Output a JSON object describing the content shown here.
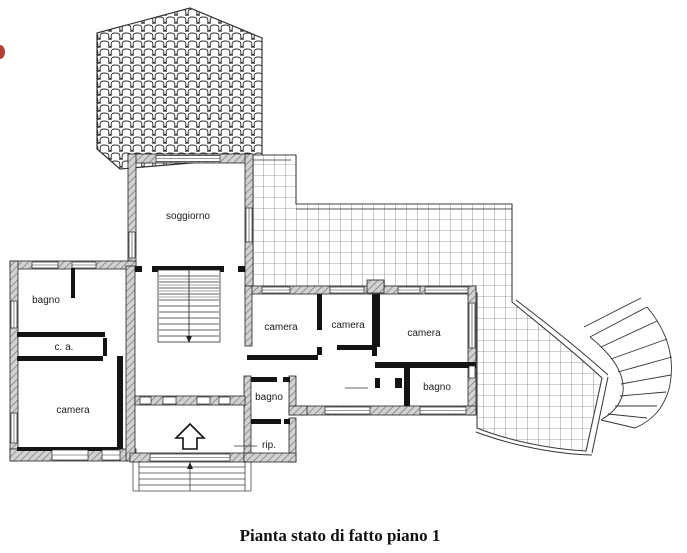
{
  "title": "Pianta stato di fatto piano 1",
  "colors": {
    "ink": "#1c1c1c",
    "wall_hatch_fill": "#d2d2d2",
    "grid_line": "#4d4d4d",
    "accent_mark": "#b4403a"
  },
  "rooms": [
    {
      "id": "soggiorno",
      "label": "soggiorno",
      "x": 188,
      "y": 219
    },
    {
      "id": "bagno-nordovest",
      "label": "bagno",
      "x": 46,
      "y": 303
    },
    {
      "id": "cabina-armadio",
      "label": "c. a.",
      "x": 64,
      "y": 350
    },
    {
      "id": "camera-ovest",
      "label": "camera",
      "x": 73,
      "y": 413
    },
    {
      "id": "camera-centro-1",
      "label": "camera",
      "x": 281,
      "y": 330
    },
    {
      "id": "camera-centro-2",
      "label": "camera",
      "x": 348,
      "y": 328
    },
    {
      "id": "camera-est",
      "label": "camera",
      "x": 424,
      "y": 336
    },
    {
      "id": "bagno-sud",
      "label": "bagno",
      "x": 269,
      "y": 400
    },
    {
      "id": "bagno-sudest",
      "label": "bagno",
      "x": 437,
      "y": 390
    },
    {
      "id": "ripostiglio",
      "label": "rip.",
      "x": 269,
      "y": 448
    }
  ]
}
